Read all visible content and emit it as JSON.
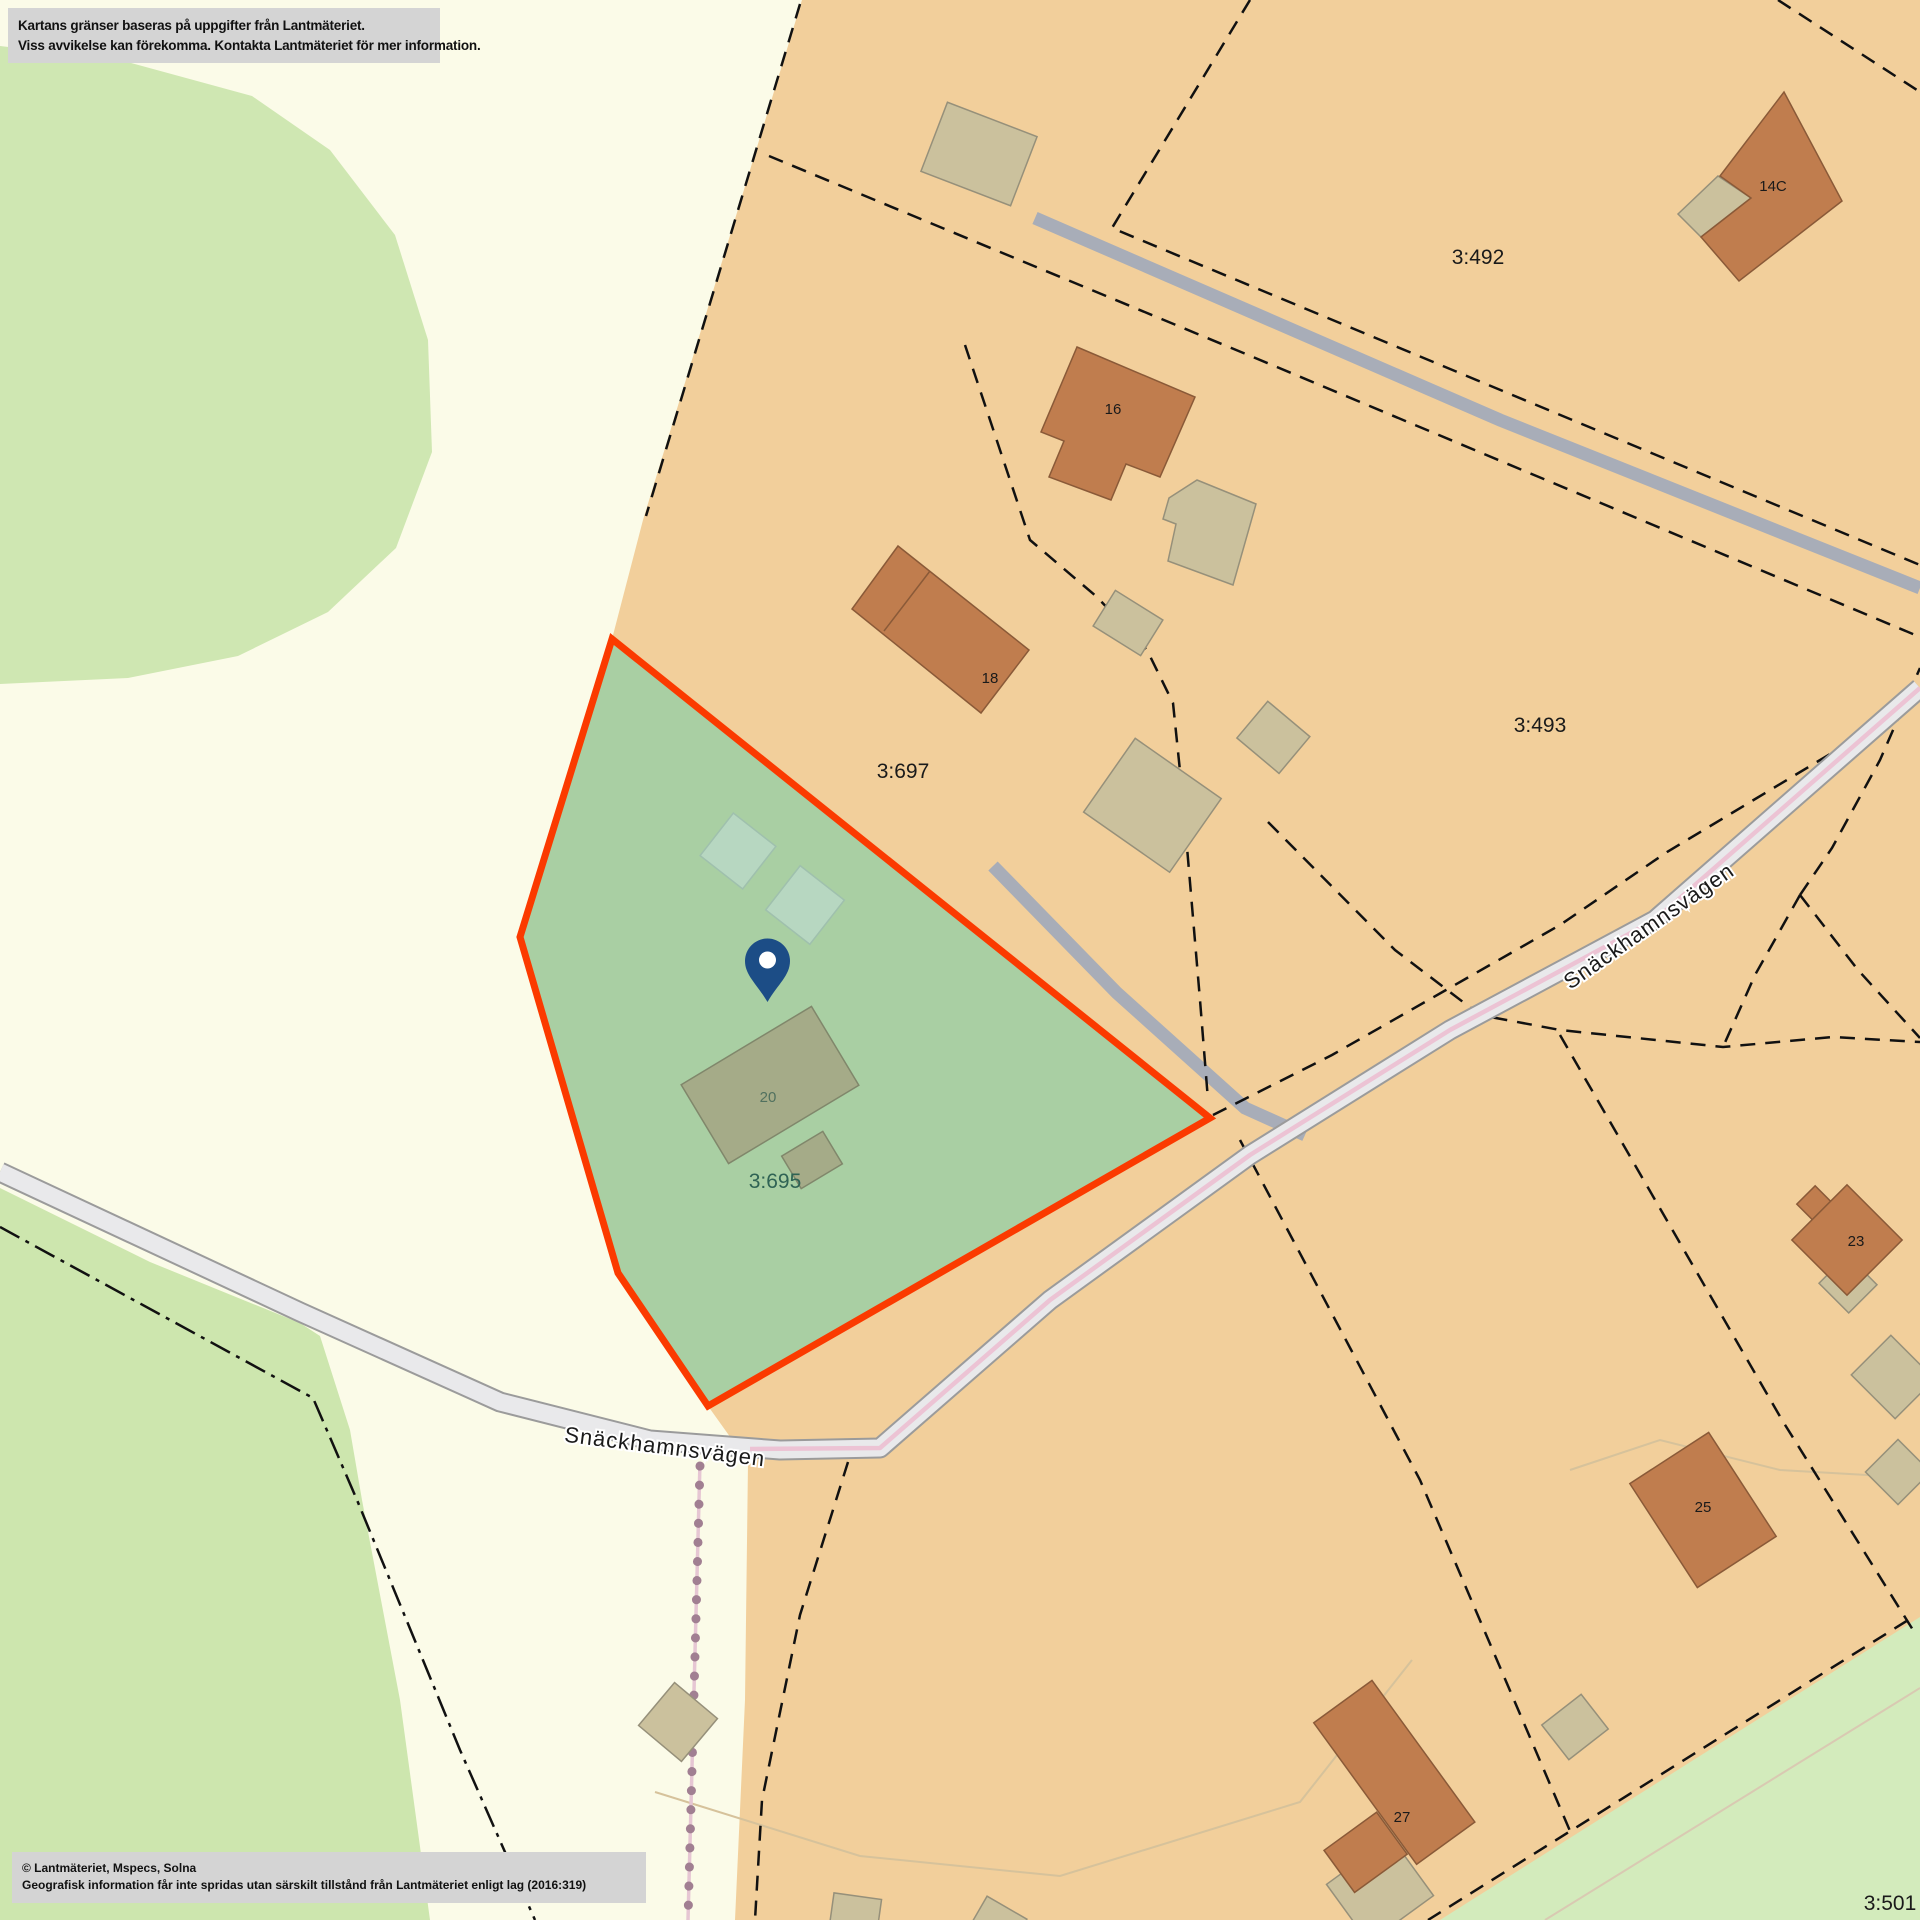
{
  "disclaimer": {
    "line1": "Kartans gränser baseras på uppgifter från Lantmäteriet.",
    "line2": "Viss avvikelse kan förekomma. Kontakta Lantmäteriet för mer information."
  },
  "attribution": {
    "line1": "© Lantmäteriet, Mspecs, Solna",
    "line2": "Geografisk information får inte spridas utan särskilt tillstånd från Lantmäteriet enligt lag (2016:319)"
  },
  "road": {
    "name": "Snäckhamnsvägen"
  },
  "parcels": {
    "p492": "3:492",
    "p493": "3:493",
    "p697": "3:697",
    "p695": "3:695",
    "p501": "3:501"
  },
  "houses": {
    "h14c": "14C",
    "h16": "16",
    "h18": "18",
    "h20": "20",
    "h23": "23",
    "h25": "25",
    "h27": "27"
  },
  "marker": {
    "type": "location-pin",
    "color": "#1c4d86"
  },
  "highlight": {
    "parcel": "3:695",
    "fill": "#a9cfa3",
    "border": "#fb3a00"
  },
  "map_colors": {
    "residential": "#f2cf9b",
    "open_land": "#fbfbe8",
    "forest": "#cfe7b2",
    "road_fill": "#e9e9eb",
    "road_center": "#ecc3d4",
    "building_main": "#c07d4e",
    "building_other": "#cbc19d"
  }
}
